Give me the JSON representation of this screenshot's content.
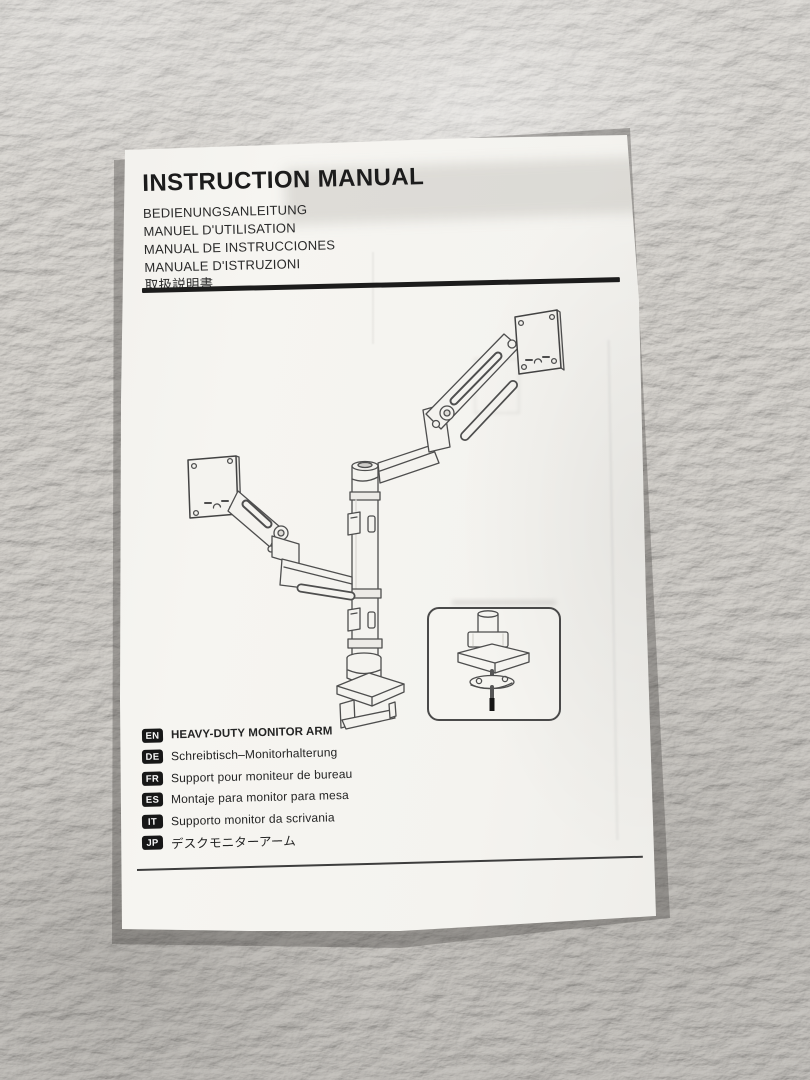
{
  "photo": {
    "scene": "instruction manual booklet lying on a fluffy light-grey carpet",
    "colors": {
      "carpet": "#d6d3ce",
      "paper": "#f4f3ef",
      "ink": "#1c1c1c",
      "line_art": "#4e4e4e",
      "badge_bg": "#171717",
      "badge_text": "#fafafa"
    }
  },
  "manual": {
    "title": "INSTRUCTION MANUAL",
    "subtitles": [
      "BEDIENUNGSANLEITUNG",
      "MANUEL D'UTILISATION",
      "MANUAL DE INSTRUCCIONES",
      "MANUALE D'ISTRUZIONI",
      "取扱説明書"
    ],
    "illustration": "dual heavy-duty monitor arm with desk clamp, line drawing",
    "inset_illustration": "grommet mount detail in rounded box",
    "languages": [
      {
        "code": "EN",
        "label": "HEAVY-DUTY MONITOR ARM"
      },
      {
        "code": "DE",
        "label": "Schreibtisch–Monitorhalterung"
      },
      {
        "code": "FR",
        "label": "Support pour moniteur de bureau"
      },
      {
        "code": "ES",
        "label": "Montaje para monitor para mesa"
      },
      {
        "code": "IT",
        "label": "Supporto monitor da scrivania"
      },
      {
        "code": "JP",
        "label": "デスクモニターアーム"
      }
    ]
  }
}
